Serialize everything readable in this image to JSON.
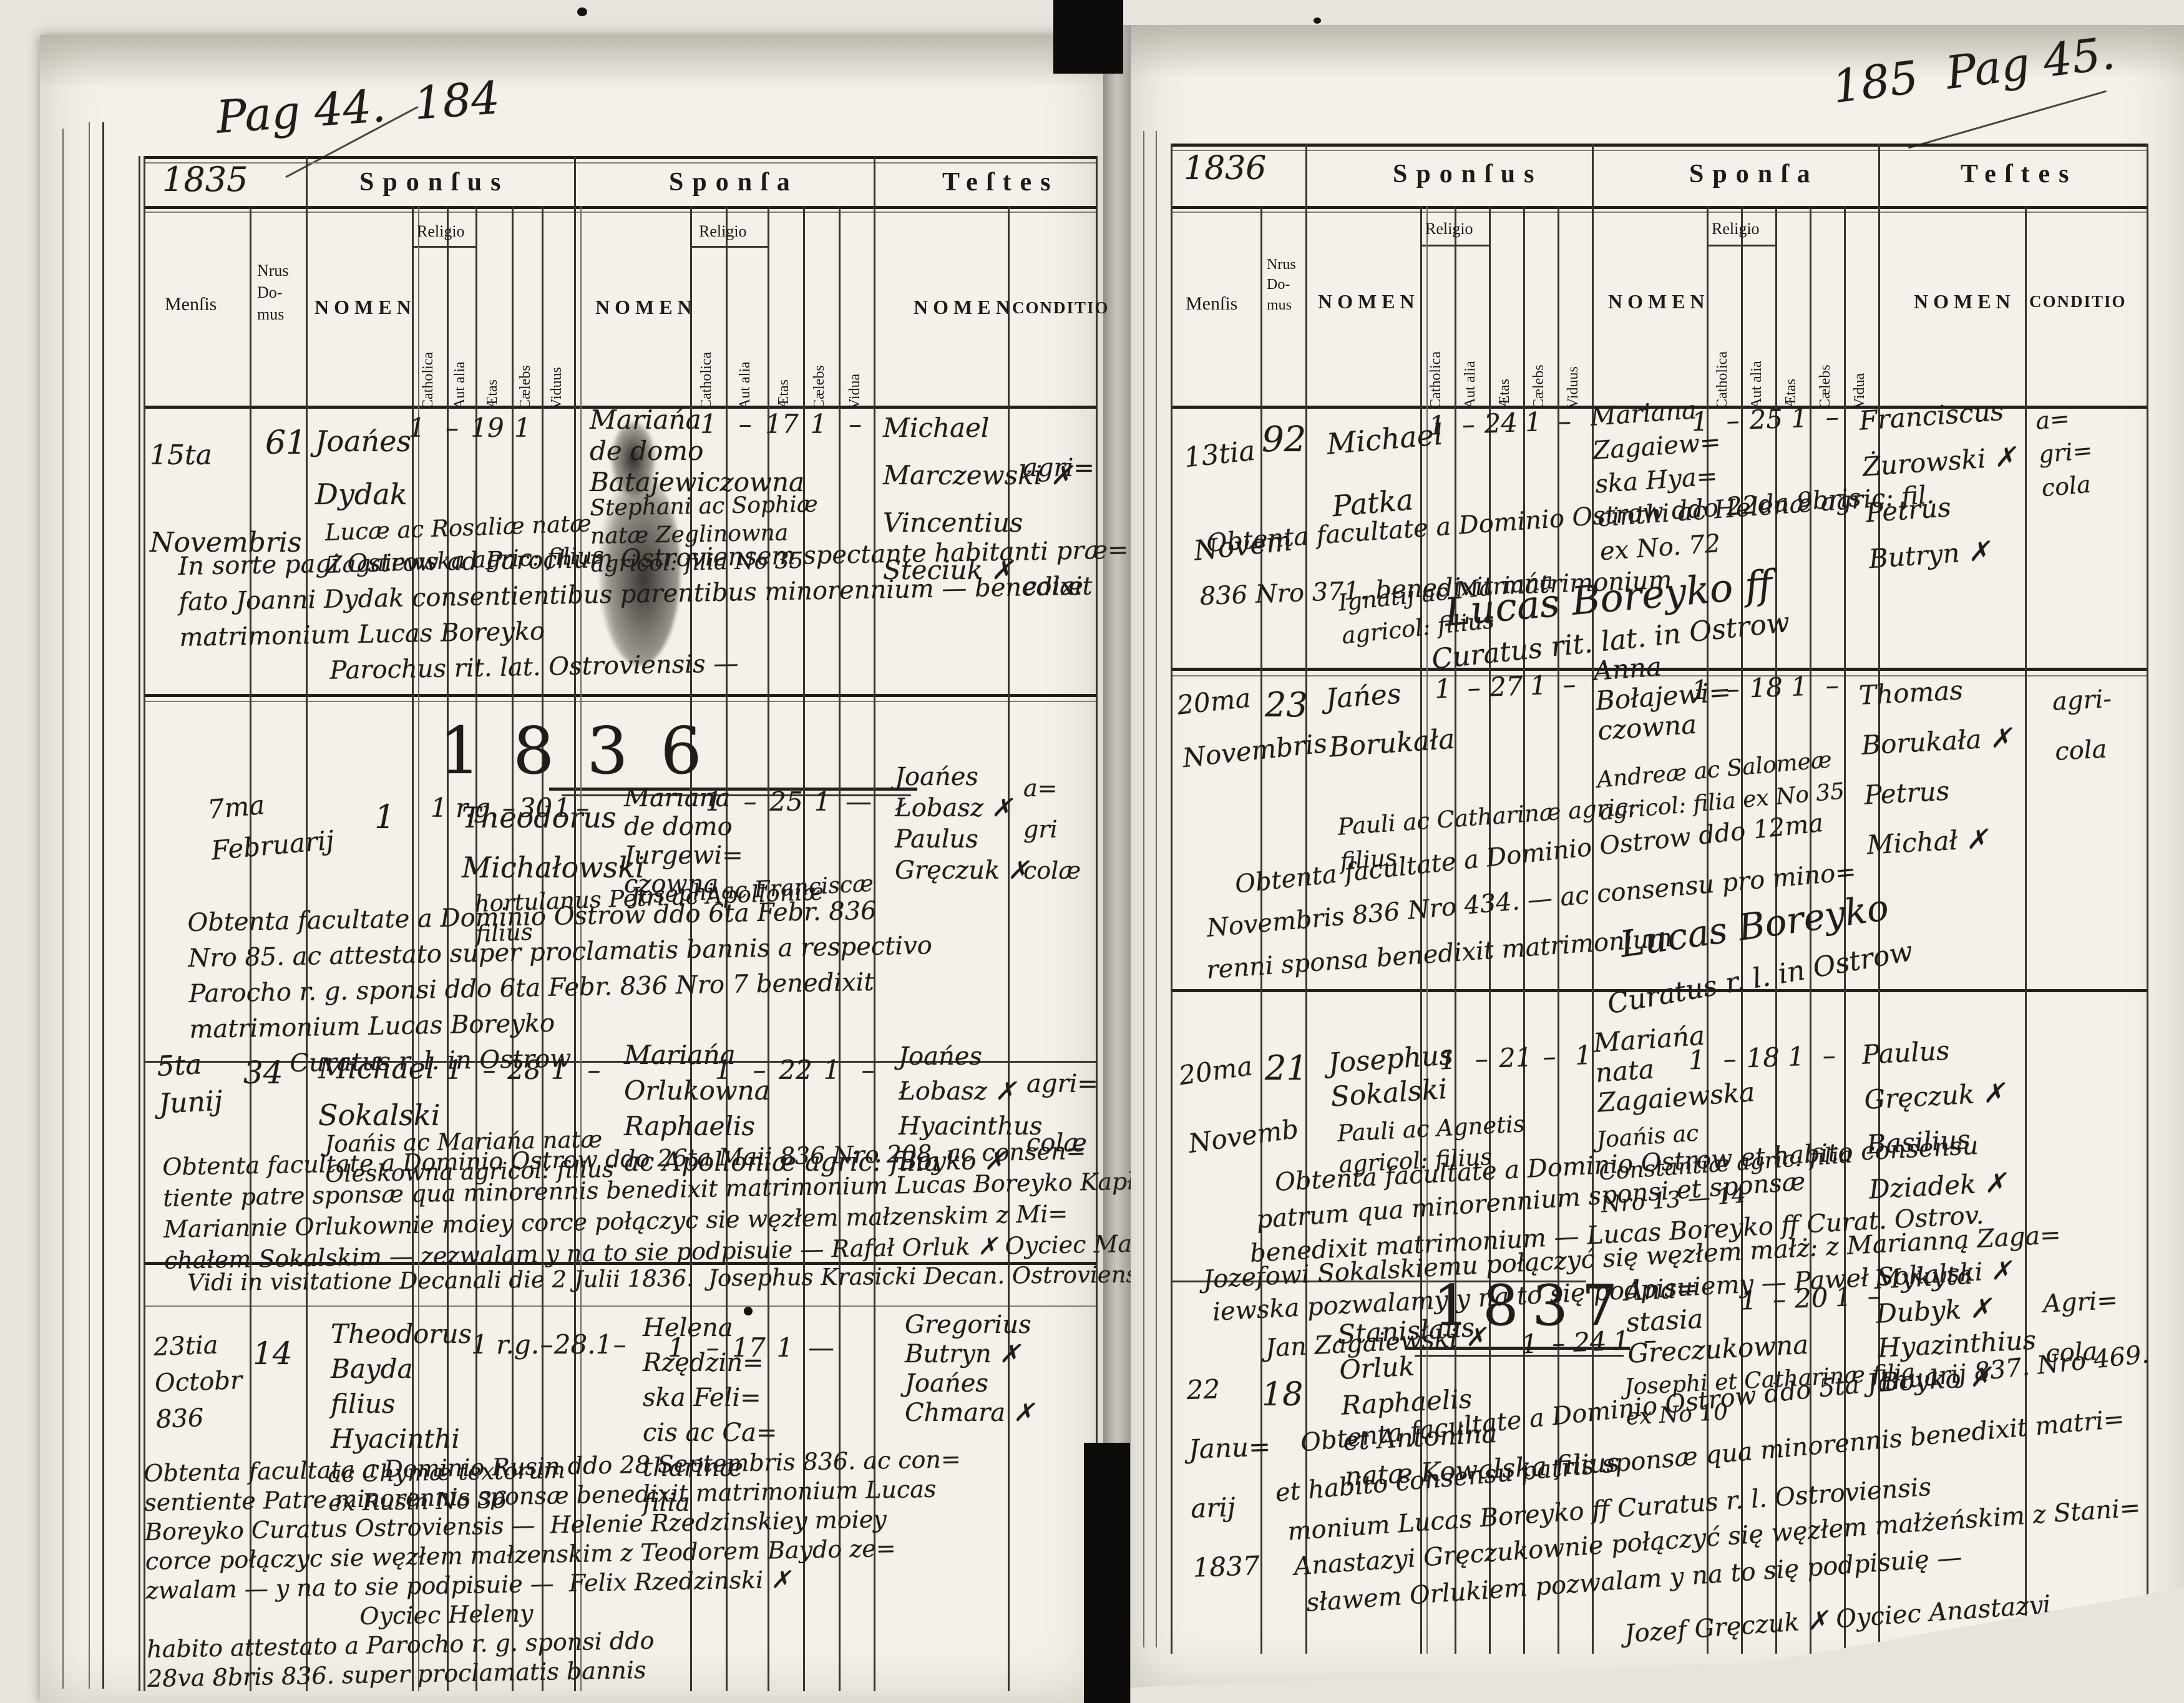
{
  "left_page": {
    "annotation": "Pag 44.  184",
    "year": "1835",
    "mid_year_heading": "1836",
    "headers": {
      "sponsus": "Sponſus",
      "sponsa": "Sponſa",
      "testes": "Teſtes",
      "mensis": "Menſis",
      "nrus_domus": "Nrus\nDo-\nmus",
      "nomen": "NOMEN",
      "religio": "Religio",
      "catholica": "Catholica",
      "aut_alia": "Aut alia",
      "aetas": "Ætas",
      "caelebs": "Cælebs",
      "viduus": "Viduus",
      "vidua": "Vidua",
      "conditio": "CONDITIO"
    },
    "records": [
      {
        "mensis": "15ta\nNovembris",
        "nrus": "61",
        "groom_name": "Joańes\nDydak",
        "groom_detail": "Lucæ ac Rosaliæ natæ\nZagaiewska agric: filius",
        "groom_marks": [
          "1",
          "–",
          "19",
          "1",
          ""
        ],
        "bride_name": "Mariańa\nde domo\nBatajewiczowna",
        "bride_detail": "Stephani ac Sophiæ\nnatæ Zeglinowna\nagricol: filia No 35",
        "bride_marks": [
          "1",
          "–",
          "17",
          "1",
          "–"
        ],
        "witnesses": "Michael\nMarczewski ✗\nVincentius\nSteciuk ✗",
        "conditio": "agri=\ncolæ",
        "note": "In sorte pagi Ostrow ad Parochum Ostroviensem spectante habitanti præ=\nfato Joanni Dydak consentientibus parentibus minorennium — benedixit\nmatrimonium Lucas Boreyko\n      Parochus rit. lat. Ostroviensis —"
      },
      {
        "mensis": "7ma\nFebruarij",
        "nrus": "1",
        "groom_name": "Theodorus\nMichałowski",
        "groom_detail": "hortulanus Petri ac Apolloniæ\nfilius",
        "groom_marks": [
          "1 r.g.",
          "–",
          "30",
          "1",
          "–"
        ],
        "bride_name": "Mariana\nde domo\nJurgewi=\nczowna",
        "bride_detail": "Josephi ac Franciscæ",
        "bride_marks": [
          "1",
          "–",
          "25",
          "1",
          "—"
        ],
        "witnesses": "Joańes\nŁobasz ✗\nPaulus\nGręczuk ✗",
        "conditio": "a=\ngri\ncolæ",
        "note": "Obtenta facultate a Dominio Ostrow ddo 6ta Febr. 836\nNro 85. ac attestato super proclamatis bannis a respectivo\nParocho r. g. sponsi ddo 6ta Febr. 836 Nro 7 benedixit\nmatrimonium Lucas Boreyko\n    Curatus r. l. in Ostrow"
      },
      {
        "mensis": "5ta\nJunij",
        "nrus": "34",
        "groom_name": "Michael\nSokalski",
        "groom_detail": "Joańis ac Mariańa natæ\nOleskowna agricol: filius",
        "groom_marks": [
          "1",
          "–",
          "28",
          "1",
          "–"
        ],
        "bride_name": "Mariańa\nOrlukowna\nRaphaelis\nac Apolloniæ agric: filia",
        "bride_marks": [
          "1",
          "–",
          "22",
          "1",
          "–"
        ],
        "witnesses": "Joańes\nŁobasz ✗\nHyacinthus\nBoyko ✗",
        "conditio": "agri=\ncolæ",
        "note": "Obtenta facultate a Dominio Ostrow ddo 26ta Maii 836 Nro 208. ac consen=\ntiente patre sponsæ qua minorennis benedixit matrimonium Lucas Boreyko Kapłan.\nMariannie Orlukownie moiey corce połączyc sie węzłem małzenskim z Mi=\nchałem Sokalskim — zezwalam y na to sie podpisuie — Rafał Orluk ✗ Oyciec Marianny"
      },
      {
        "mensis": "23tia\nOctobr\n836",
        "nrus": "14",
        "groom_name": "Theodorus\nBayda\nfilius\nHyacinthi",
        "groom_detail": "ac Chymæ textorum\nex Rusin No 36",
        "groom_marks": [
          "1 r.g.",
          "–",
          "28.",
          "1",
          "–"
        ],
        "bride_name": "Helena\nRzędzin=\nska Feli=\ncis ac Ca=\ntharinæ\nfilia",
        "bride_marks": [
          "1",
          "–",
          "17",
          "1",
          "—"
        ],
        "witnesses": "Gregorius\nButryn ✗\nJoańes\nChmara ✗",
        "conditio": "",
        "note": "Obtenta facultata a Dominio Rusin ddo 28 Septembris 836. ac con=\nsentiente Patre minorennis sponsæ benedixit matrimonium Lucas\nBoreyko Curatus Ostroviensis —  Helenie Rzedzinskiey moiey\ncorce połączyc sie węzłem małzenskim z Teodorem Baydo ze=\nzwalam — y na to sie podpisuie —  Felix Rzedzinski ✗\n         Oyciec Heleny\nhabito attestato a Parocho r. g. sponsi ddo\n28va 8bris 836. super proclamatis bannis"
      }
    ],
    "visitation": "Vidi in visitatione Decanali die 2 Julii 1836.  Josephus Krasicki Decan. Ostroviensis m. p."
  },
  "right_page": {
    "annotation": "185  Pag 45.",
    "year": "1836",
    "mid_year_heading": "1837",
    "headers": {
      "sponsus": "Sponſus",
      "sponsa": "Sponſa",
      "testes": "Teſtes",
      "mensis": "Menſis",
      "nrus_domus": "Nrus\nDo-\nmus",
      "nomen": "NOMEN",
      "religio": "Religio",
      "catholica": "Catholica",
      "aut_alia": "Aut alia",
      "aetas": "Ætas",
      "caelebs": "Cælebs",
      "viduus": "Viduus",
      "vidua": "Vidua",
      "conditio": "CONDITIO"
    },
    "records": [
      {
        "mensis": "13tia\nNovem",
        "nrus": "92",
        "groom_name": "Michael\nPatka",
        "groom_detail": "Ignatij ac Mariańa\nagricol: filius",
        "groom_marks": [
          "1",
          "–",
          "24",
          "1",
          "–"
        ],
        "bride_name": "Mariana\nZagaiew=\nska Hya=\ncinthi ac Helenæ agric: fil.\nex No. 72",
        "bride_marks": [
          "1",
          "–",
          "25",
          "1",
          "–"
        ],
        "witnesses": "Franciscus\nŻurowski ✗\nPetrus\nButryn ✗",
        "conditio": "a=\ngri=\ncola",
        "note_lines": [
          "Obtenta facultate a Dominio Ostrow ddo 22da 9bris",
          "836 Nro 371. benedixit matrimonium"
        ],
        "signature": "Lucas Boreyko ff",
        "signature2": "Curatus rit. lat. in Ostrow"
      },
      {
        "mensis": "20ma\nNovembris",
        "nrus": "23",
        "groom_name": "Jańes\nBorukała",
        "groom_detail": "Pauli ac Catharinæ agric:\nfilius",
        "groom_marks": [
          "1",
          "–",
          "27",
          "1",
          "–"
        ],
        "bride_name": "Anna\nBołajewi=\nczowna",
        "bride_detail": "Andreæ ac Salomeæ\nagricol: filia ex No 35",
        "bride_marks": [
          "1",
          "–",
          "18",
          "1",
          "–"
        ],
        "witnesses": "Thomas\nBorukała ✗\nPetrus\nMichał ✗",
        "conditio": "agri-\ncola",
        "note_lines": [
          "Obtenta facultate a Dominio Ostrow ddo 12ma",
          "Novembris 836 Nro 434. — ac consensu pro mino=",
          "renni sponsa benedixit matrimonium"
        ],
        "signature": "Lucas Boreyko",
        "signature2": "Curatus r. l. in Ostrow"
      },
      {
        "mensis": "20ma\nNovemb",
        "nrus": "21",
        "groom_name": "Josephus\nSokalski",
        "groom_detail": "Pauli ac Agnetis\nagricol: filius",
        "groom_marks": [
          "1",
          "–",
          "21",
          "–",
          "1"
        ],
        "bride_name": "Mariańa\nnata\nZagaiewska",
        "bride_detail": "Joańis ac\nConstantiæ agric: filia\nNro 13 — 14",
        "bride_marks": [
          "1",
          "–",
          "18",
          "1",
          "–"
        ],
        "witnesses": "Paulus\nGręczuk ✗\nBasilius\nDziadek ✗",
        "conditio": "",
        "note_lines": [
          "Obtenta facultate a Dominio Ostrow et habito consensu",
          "patrum qua minorennium sponsi et sponsæ",
          "benedixit matrimonium — Lucas Boreyko ff Curat. Ostrov.",
          "Jozefowi Sokalskiemu połączyć się węzłem małż: z Marianną Zaga=",
          "iewska pozwalamy y na to się podpisuiemy — Paweł Sokalski ✗",
          "Jan Zagaiewski ✗"
        ]
      },
      {
        "mensis": "22\nJanu=\narij\n1837",
        "nrus": "18",
        "groom_name": "Stanisłaus\nOrluk\nRaphaelis\net Antonina\nnatæ Kowalska filius",
        "groom_marks": [
          "1",
          "–",
          "24",
          "1",
          "–"
        ],
        "bride_name": "Ana=\nstasia\nGreczukowna",
        "bride_detail": "Josephi et Catharinæ filia\nex No 10",
        "bride_marks": [
          "1",
          "–",
          "20",
          "1",
          "–"
        ],
        "witnesses": "Mykyta\nDubyk ✗\nHyazinthius\nBoyko ✗",
        "conditio": "Agri=\ncola",
        "note_lines": [
          "Obtenta facultate a Dominio Ostrow ddo 5ta Januarij 837. Nro 469.",
          "et habito consensu patris sponsæ qua minorennis benedixit matri=",
          "monium Lucas Boreyko ff Curatus r. l. Ostroviensis",
          "Anastazyi Gręczukownie połączyć się węzłem małżeńskim z Stani=",
          "sławem Orlukiem pozwalam y na to się podpisuię —",
          "Jozef Gręczuk ✗ Oyciec Anastazyi"
        ]
      }
    ]
  }
}
